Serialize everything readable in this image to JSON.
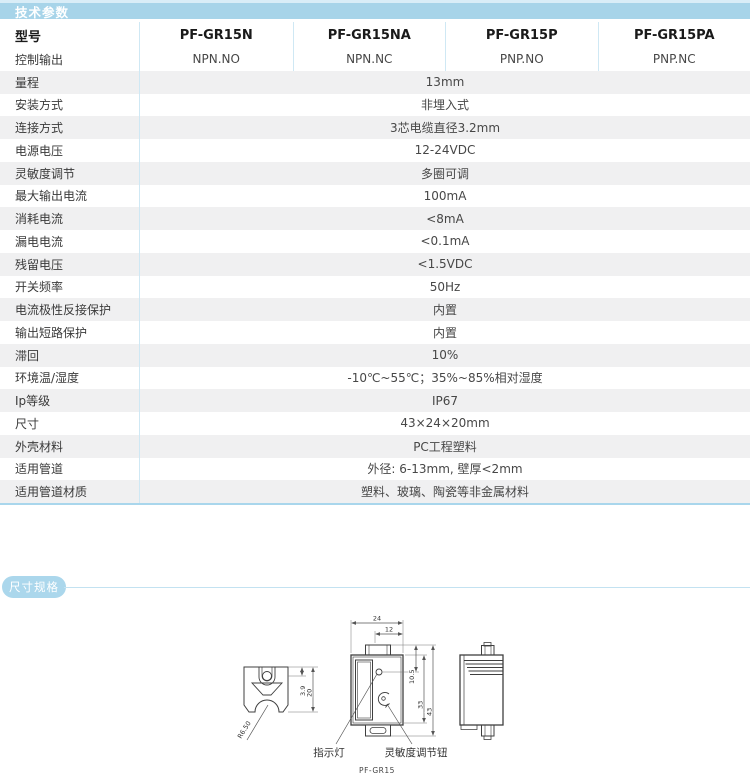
{
  "tech_params": {
    "section_title": "技术参数",
    "header": {
      "model_label": "型号",
      "models": [
        "PF-GR15N",
        "PF-GR15NA",
        "PF-GR15P",
        "PF-GR15PA"
      ]
    },
    "output_row": {
      "label": "控制输出",
      "values": [
        "NPN.NO",
        "NPN.NC",
        "PNP.NO",
        "PNP.NC"
      ]
    },
    "rows": [
      {
        "label": "量程",
        "value": "13mm"
      },
      {
        "label": "安装方式",
        "value": "非埋入式"
      },
      {
        "label": "连接方式",
        "value": "3芯电缆直径3.2mm"
      },
      {
        "label": "电源电压",
        "value": "12-24VDC"
      },
      {
        "label": "灵敏度调节",
        "value": "多圈可调"
      },
      {
        "label": "最大输出电流",
        "value": "100mA"
      },
      {
        "label": "消耗电流",
        "value": "<8mA"
      },
      {
        "label": "漏电电流",
        "value": "<0.1mA"
      },
      {
        "label": "残留电压",
        "value": "<1.5VDC"
      },
      {
        "label": "开关频率",
        "value": "50Hz"
      },
      {
        "label": "电流极性反接保护",
        "value": "内置"
      },
      {
        "label": "输出短路保护",
        "value": "内置"
      },
      {
        "label": "滞回",
        "value": "10%"
      },
      {
        "label": "环境温/湿度",
        "value": "-10℃~55℃；35%~85%相对湿度"
      },
      {
        "label": "Ip等级",
        "value": "IP67"
      },
      {
        "label": "尺寸",
        "value": "43×24×20mm"
      },
      {
        "label": "外壳材料",
        "value": "PC工程塑料"
      },
      {
        "label": "适用管道",
        "value": "外径: 6-13mm, 壁厚<2mm"
      },
      {
        "label": "适用管道材质",
        "value": "塑料、玻璃、陶瓷等非金属材料"
      }
    ]
  },
  "dimensions": {
    "section_title": "尺寸规格",
    "drawing_model": "PF-GR15",
    "callouts": {
      "indicator": "指示灯",
      "sensitivity_knob": "灵敏度调节钮"
    },
    "dims": {
      "top_width": "24",
      "tab_width": "12",
      "led_offset": "10.5",
      "body_height": "33",
      "total_height": "43",
      "slot_depth": "3.9",
      "top_view_height": "20",
      "groove_radius": "R6.50"
    }
  },
  "colors": {
    "band_blue": "#a7d4e9",
    "separator_blue": "#cfe8f4",
    "table_bottom_blue": "#a9d6ec",
    "shaded_row": "#f0f0f1"
  }
}
